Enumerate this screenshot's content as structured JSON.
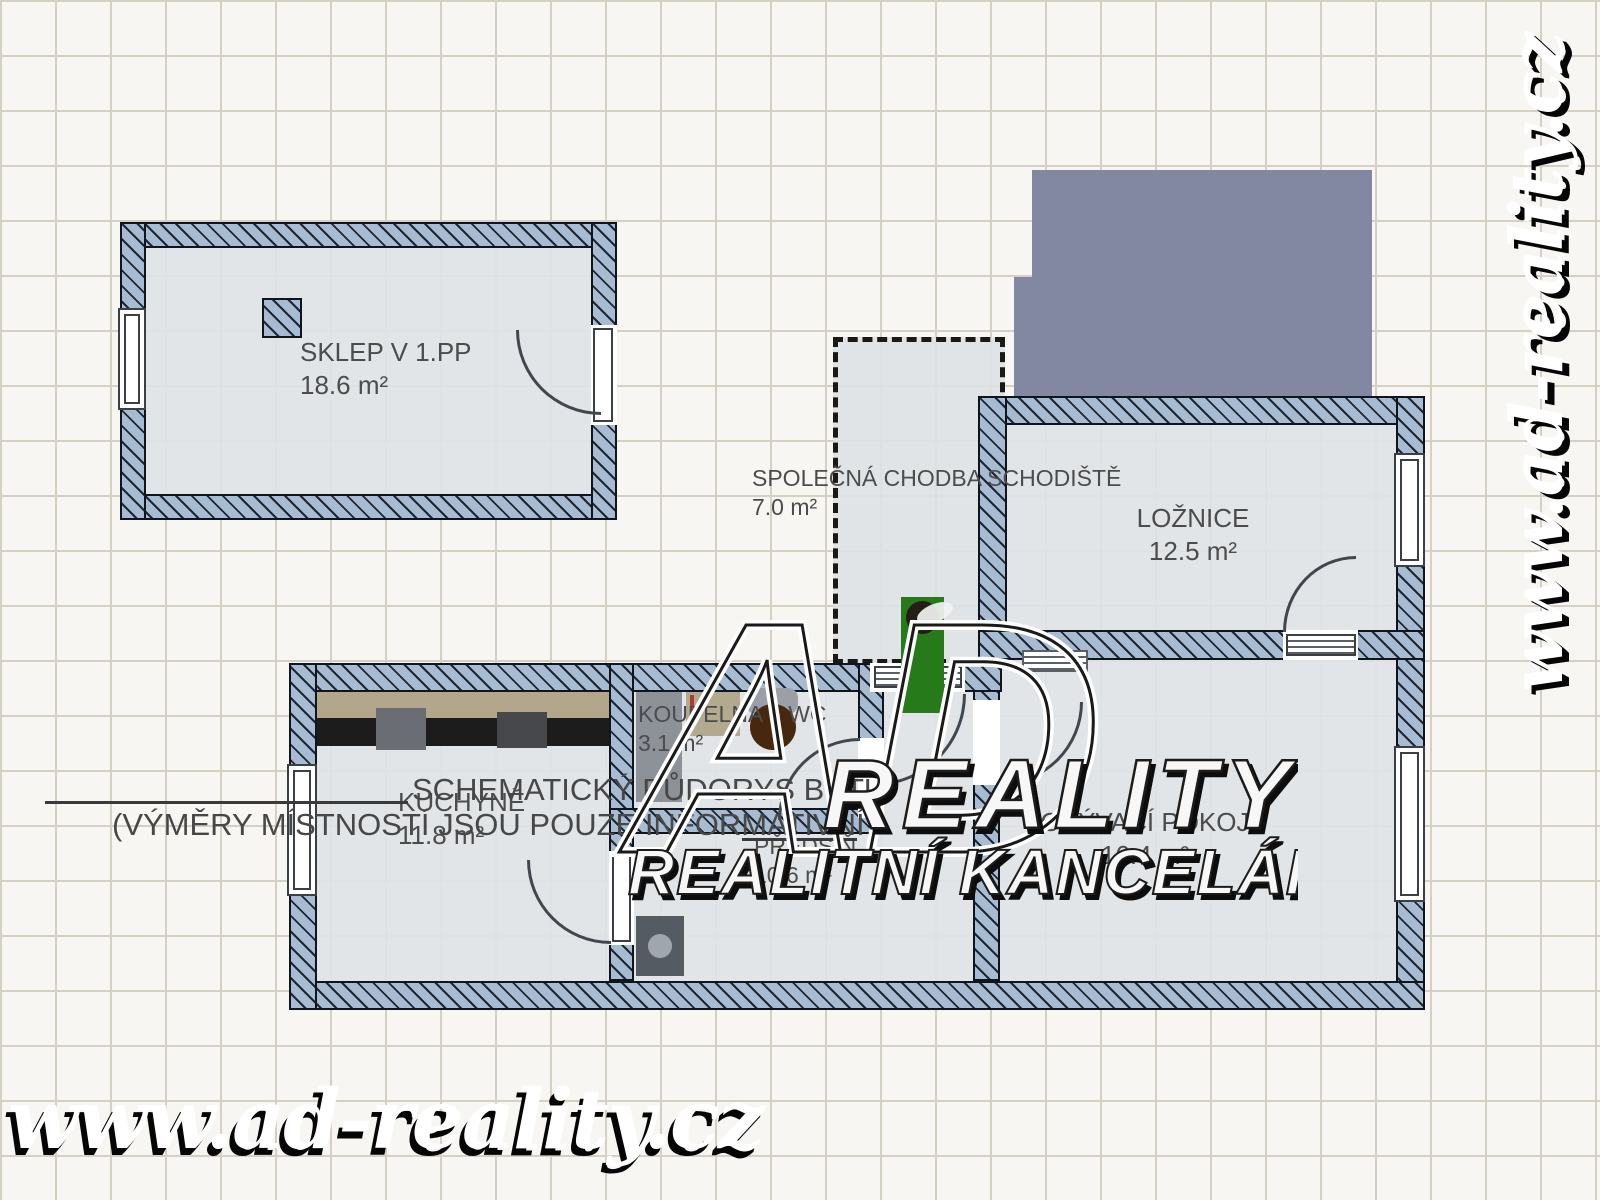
{
  "rooms": {
    "sklep": {
      "name": "SKLEP V 1.PP",
      "area": "18.6 m²"
    },
    "corridor": {
      "name": "SPOLEČNÁ CHODBA SCHODIŠTĚ",
      "area": "7.0 m²"
    },
    "bedroom": {
      "name": "LOŽNICE",
      "area": "12.5 m²"
    },
    "bathroom": {
      "name": "KOUPELNA + WC",
      "area": "3.1 m²"
    },
    "kitchen": {
      "name": "KUCHYNĚ",
      "area": "11.8 m²"
    },
    "hall": {
      "name": "PŘEDSÍŇ",
      "area": "10.6 m²"
    },
    "living": {
      "name": "OBÝVACÍ POKOJ",
      "area": "16.4 m²"
    }
  },
  "disclaimer": {
    "line1": "SCHEMATICKÝ PŮDORYS BYTU",
    "line2": "(VÝMĚRY MÍSTNOSTÍ JSOU POUZE INFORMATIVNÍ"
  },
  "watermark": {
    "url": "www.ad-reality.cz"
  },
  "logo": {
    "monogram": "AD",
    "line1": "REALITY",
    "line2": "REALITNÍ KANCELÁŘ"
  },
  "colors": {
    "wall_fill": "#a7bbd2",
    "wall_stripe": "#1e2631",
    "wall_border": "#10151d",
    "floor": "#e0e3e6",
    "building_block": "#8287a2",
    "plant": "#277a1a",
    "counter_top": "#b2a78a",
    "counter_dark": "#1c1c1c",
    "toilet": "#47280f",
    "grid_line": "#d6d0c4",
    "background": "#f7f6f2",
    "label_text": "#4c4c4c"
  }
}
